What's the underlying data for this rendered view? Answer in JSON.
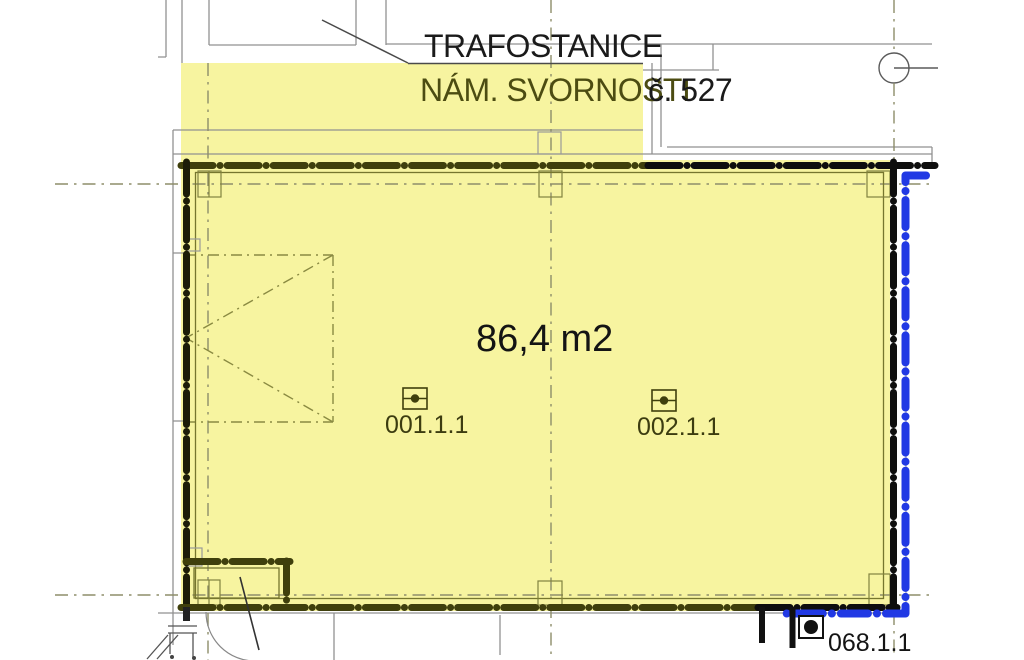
{
  "drawing": {
    "building_label": "TRAFOSTANICE",
    "address": "NÁM. SVORNOSTI",
    "address_number": "č. 527",
    "area_label": "86,4 m2",
    "room_1": "001.1.1",
    "room_2": "002.1.1",
    "room_3": "068.1.1"
  },
  "colors": {
    "highlight_yellow": "#f7f4a0",
    "boundary_olive": "#3f3f0c",
    "boundary_black": "#0e0e0e",
    "parcel_blue": "#2139e4",
    "thin_gray": "#919191",
    "axis_gray": "#8d8d6a"
  }
}
